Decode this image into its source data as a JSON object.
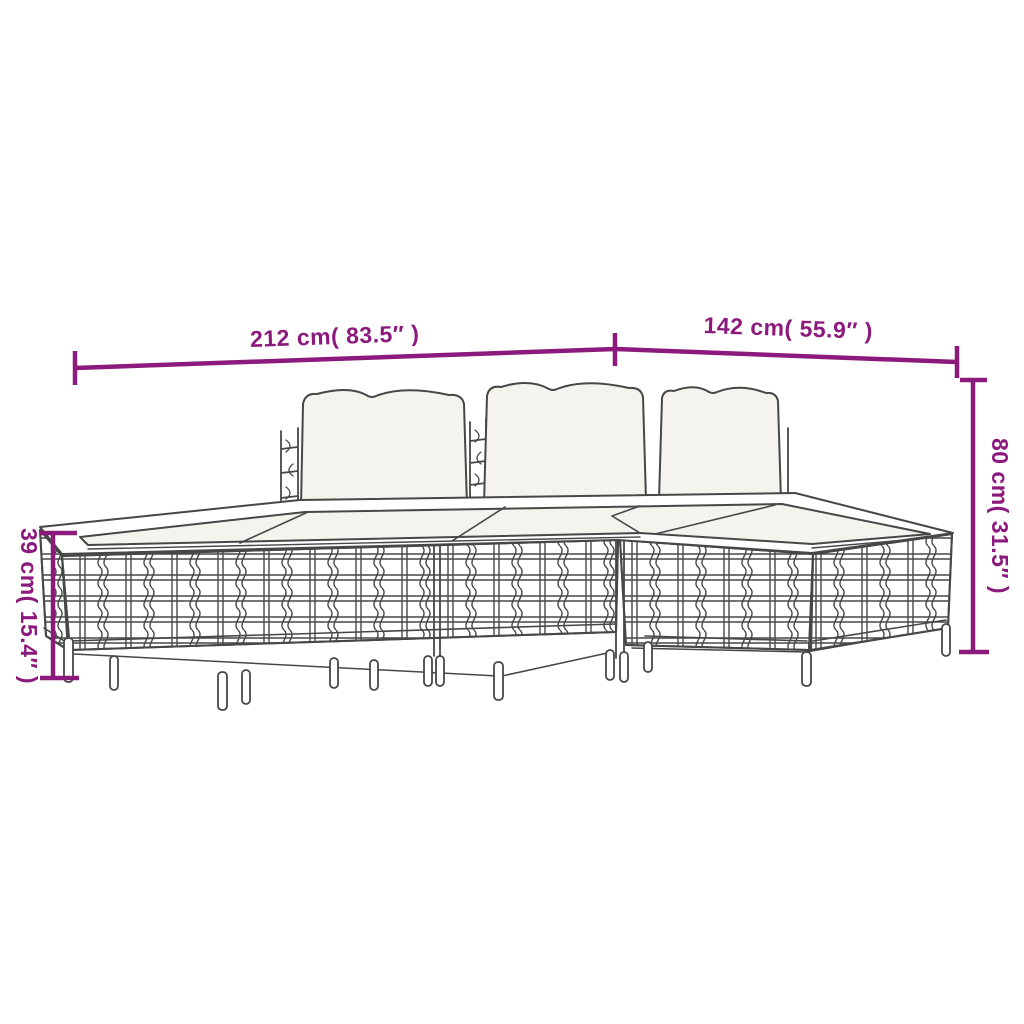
{
  "meta": {
    "description": "Product dimension diagram of a 4-piece poly rattan modular garden lounge set with cushions, drawn as grayscale line art with magenta measurement lines",
    "background": "#FFFFFF"
  },
  "colors": {
    "dimension": "#8C1A7D",
    "outline": "#474747",
    "cushion_fill": "#F4F3EE",
    "white": "#FFFFFF"
  },
  "dimensions": {
    "total_width": {
      "label": "212 cm( 83.5″ )",
      "value_cm": "212",
      "value_in": "83.5"
    },
    "side_depth": {
      "label": "142 cm( 55.9″ )",
      "value_cm": "142",
      "value_in": "55.9"
    },
    "back_height": {
      "label": "80 cm( 31.5″ )",
      "value_cm": "80",
      "value_in": "31.5"
    },
    "seat_height": {
      "label": "39 cm( 15.4″ )",
      "value_cm": "39",
      "value_in": "15.4"
    }
  },
  "product": {
    "pieces": [
      "ottoman section",
      "left sofa section",
      "middle sofa section",
      "right corner extension section"
    ],
    "features": [
      "three back cushions",
      "L-shaped seat cushion row",
      "woven rattan side panels",
      "short round legs"
    ]
  }
}
